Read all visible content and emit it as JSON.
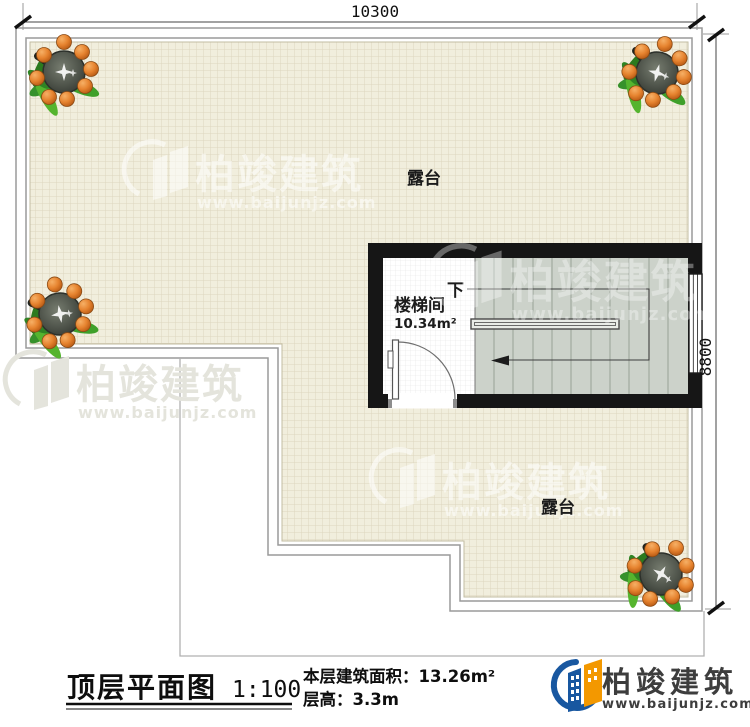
{
  "dimensions": {
    "top": "10300",
    "right": "8800"
  },
  "labels": {
    "terrace_top": "露台",
    "terrace_bottom": "露台",
    "stairwell": "楼梯间",
    "stairwell_area": "10.34m²",
    "down": "下"
  },
  "watermark": {
    "title": "柏竣建筑",
    "url": "www.baijunjz.com"
  },
  "legend": {
    "title": "顶层平面图",
    "scale": "1:100",
    "area_line": "本层建筑面积：13.26m²",
    "height_line": "层高：3.3m"
  },
  "logo": {
    "name": "柏竣建筑",
    "url": "www.baijunjz.com"
  },
  "colors": {
    "tile": "#f1eedd",
    "tile_grid": "#ddd6bf",
    "wall": "#161616",
    "stair_fill": "#ccd2ca",
    "boundary_line": "#9a9a9a",
    "logo_blue": "#1857a0",
    "logo_orange": "#f39800"
  }
}
